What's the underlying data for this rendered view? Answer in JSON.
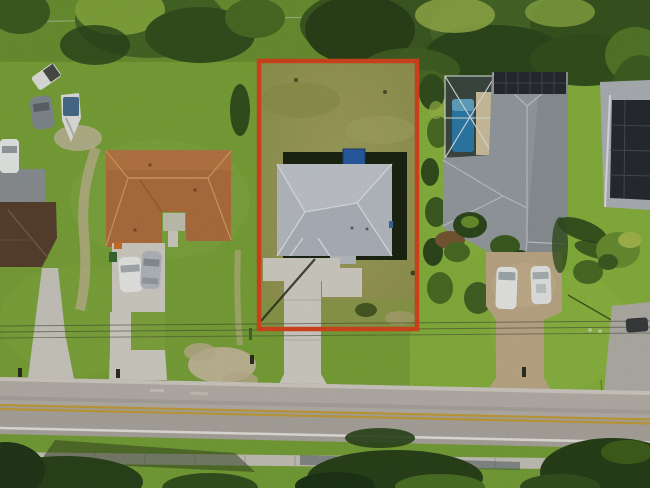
{
  "scene": {
    "type": "aerial-drone-photo",
    "description": "Top-down aerial photograph of a suburban Florida street. The center residential lot is outlined with a red property-boundary rectangle. Neighboring homes sit left and right; a two-lane road with double yellow centerline and a sidewalk run along the bottom.",
    "annotation_label": "subject-property-boundary"
  },
  "colors": {
    "outline_red": "#d9481f",
    "grass_left": "#7da73b",
    "grass_right": "#8ab63f",
    "grass_top": "#6e9533",
    "subject_lawn": "#9c9e58",
    "tree_dark": "#2c461b",
    "tree_mid": "#3f5f23",
    "tree_light": "#5d8029",
    "palm_yellow": "#9db84d",
    "shadow_dark": "#1c2613",
    "subject_roof": "#bdc2c9",
    "subject_roof_ridge": "#e3e6ea",
    "left_roof": "#b47240",
    "left_roof_ridge": "#d9a166",
    "farleft_roof": "#5a4331",
    "pool_house_roof": "#9aa0a5",
    "solar_panel": "#282c32",
    "pool_water": "#2e7eae",
    "pool_deck": "#d5c7a4",
    "enclosure_frame": "#e6e8e4",
    "paver_tan": "#c3ae8b",
    "concrete": "#d7d4cb",
    "dirt_sand": "#c6b796",
    "road_asphalt": "#afaaa2",
    "road_asphalt_light": "#bab5ad",
    "road_yellow": "#c8a13a",
    "road_white": "#e9e7e0",
    "sidewalk": "#cac7be",
    "vehicle_white": "#f0f1ef",
    "vehicle_gray": "#868e92",
    "boat_cover": "#4b7090",
    "blue_tarp": "#2a5fa8"
  },
  "objects": {
    "subject_lot": "red-outlined lot with gray hip-roof house, olive lawn, concrete driveway to street",
    "left_house": "tan shingle U-shaped roof house with double driveway, two parked cars",
    "farleft_house": "dark brown roof house at left edge with narrow drive",
    "left_vehicles": "pickup truck, gray car, covered boat, white van",
    "right_house": "large gray roof home with rooftop solar panels, screened blue pool, paver circular drive, two white vans, palm trees",
    "farright_house": "gray roof home with solar array and paver drive at right edge",
    "road": "two-lane asphalt road, double yellow centerline, white edge lines",
    "sidewalk": "concrete sidewalk with tree shadows below road",
    "utilities": "overhead utility wires crossing mid-frame"
  }
}
